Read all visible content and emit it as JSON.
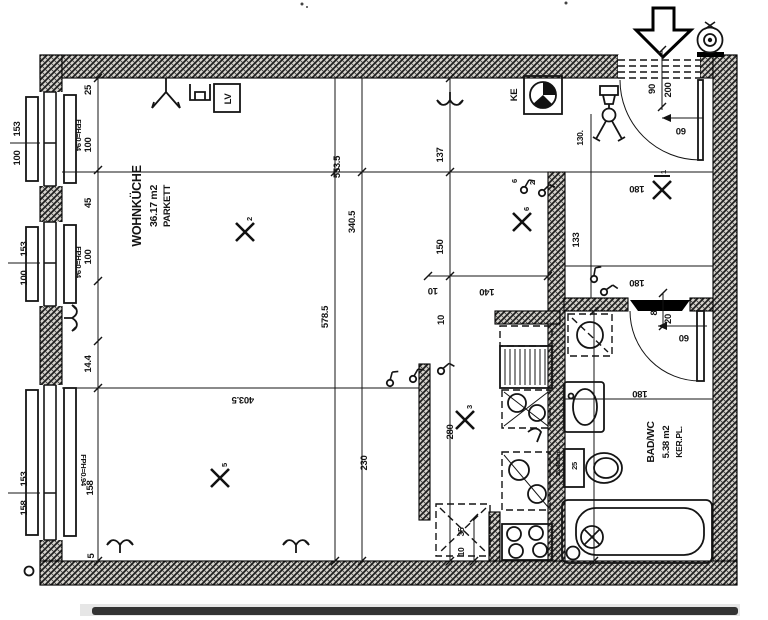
{
  "plan": {
    "rooms": [
      {
        "name": "WOHNKÜCHE",
        "area": "36.17 m2",
        "finish": "PARKETT"
      },
      {
        "name": "BAD/WC",
        "area": "5.38 m2",
        "finish": "KER.PL."
      }
    ],
    "labels": {
      "ke": "KE",
      "lv": "LV",
      "window_sill": "FPH=0.94",
      "shaft": "25x40/1cm",
      "wc_width": "25"
    },
    "markers": {
      "glyph": "X",
      "m1": "1",
      "m2": "2",
      "m3": "3",
      "m5": "5",
      "m6": "6",
      "switch_a": "6",
      "switch_b": "2"
    },
    "dims": {
      "outside_left": [
        "153",
        "100",
        "153",
        "100",
        "153",
        "158"
      ],
      "left_chain": [
        "25",
        "100",
        "45",
        "100",
        "14.4",
        "158",
        "5"
      ],
      "column_a": [
        "553.5",
        "340.5",
        "578.5",
        "230"
      ],
      "column_b": [
        "137",
        "150",
        "10",
        "280"
      ],
      "flipped": [
        "140",
        "10",
        "403.5",
        "60",
        "60",
        "180",
        "180",
        "180"
      ],
      "right": [
        "133",
        "130."
      ],
      "entrance_door": [
        "90",
        "200"
      ],
      "bath_door": [
        "8",
        "20"
      ],
      "niche": [
        "35",
        "10"
      ]
    }
  }
}
